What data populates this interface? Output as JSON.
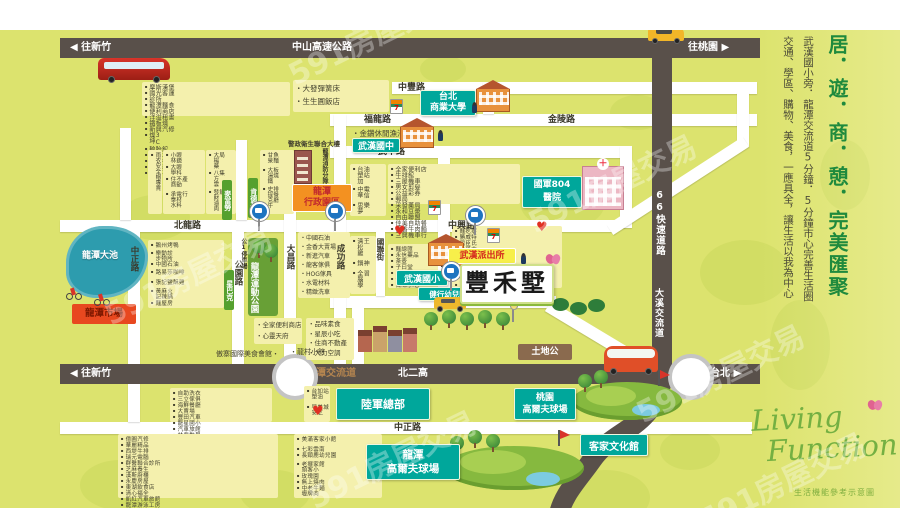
{
  "watermark_text": "591房屋交易",
  "highways": {
    "top": {
      "left": "◀ 往新竹",
      "name": "中山高速公路",
      "right": "往桃園 ▶"
    },
    "east": {
      "name": "66快速道路",
      "lower": "大溪交流道"
    },
    "bottom": {
      "left": "◀ 往新竹",
      "interchange": "龍潭交流道",
      "name": "北二高",
      "right": "往台北 ▶"
    }
  },
  "roads": {
    "zhongfeng": "中豐路",
    "fulong": "福龍路",
    "jinling": "金陵路",
    "dongfeng": "東豐路",
    "wuzhong": "武中路",
    "beilong": "北龍路",
    "zhongxing": "中興路",
    "jianxing": "健行路",
    "zhongzheng": "中正路",
    "zhongzheng_v": "中正路",
    "gongyuan": "公園路",
    "dachang": "大昌路",
    "chenggong": "成功路",
    "guolian": "國聯街",
    "wuhan": "武漢路"
  },
  "landmarks": {
    "ntub": {
      "l1": "台北",
      "l2": "商業大學"
    },
    "wuhan_jhs": "武漢國中",
    "union_bldg": "警政衛生聯合大樓",
    "fire_dept": "龍潭消防分隊",
    "admin": {
      "l1": "龍潭",
      "l2": "行政園區"
    },
    "hospital": {
      "l1": "國軍804",
      "l2": "醫院"
    },
    "wuhan_es": "武漢國小",
    "kindergarten": "健行幼兒園",
    "police": "武漢派出所",
    "project": "豐禾墅",
    "tudigong": "土地公",
    "lake": "龍潭大池",
    "market": "龍潭市場",
    "sport_park": "龍潭運動公園",
    "army": "陸軍總部",
    "golf_ty": {
      "l1": "桃園",
      "l2": "高爾夫球場"
    },
    "golf_lt": {
      "l1": "龍潭",
      "l2": "高爾夫球場"
    },
    "hakka": "客家文化館",
    "parking": "公1停車場"
  },
  "chains": {
    "mcdonalds": "麥當勞",
    "kfc": "肯德基",
    "starbucks": "星巴克"
  },
  "shops": {
    "top_left_strip": [
      "摩斯漢堡",
      "國光客運",
      "診所",
      "龍潭麵食",
      "便利商店",
      "洋溢租書",
      "鐵板燒",
      "新興汽修",
      "燦坤3C",
      "輪胎館",
      "管樂坊",
      "樂器行",
      "芸頂科技",
      "如昧花生"
    ],
    "top_bullets": [
      "大發彈簧床",
      "生生圓飯店"
    ],
    "pond_bullet": "・金鑽休閒漁池",
    "beilong_n_a": [
      "雨衣安全帽專賣"
    ],
    "beilong_n_b": [
      "小林眼鏡",
      "大學眼科",
      "住商不動產",
      "承泰水電材料行"
    ],
    "beilong_n_c": [
      "大楊藥局",
      "八方雲集",
      "發財滷肉飯"
    ],
    "beilong_n_d": [
      "甘泉魚麵",
      "大湯鐵板燒",
      "史提克牛排餐廳"
    ],
    "beilong_s": [
      "鵝州烤鴨",
      "樂步動物診所",
      "中國石油",
      "路易莎咖啡",
      "張記鹽酥雞",
      "黃記麻辣火鍋",
      "麵屋房"
    ],
    "telecom_col": [
      "台塑加油站",
      "中華電信",
      "思夢樂"
    ],
    "wuzhong_s": [
      "全家便利店",
      "牛排館",
      "三屋機車",
      "男女剪髮",
      "公益彩券",
      "郵局",
      "采發藥局",
      "永和豆漿",
      "自由聯盟",
      "佳美自助餐",
      "日香牛肉麵",
      "三興機車行"
    ],
    "zhongxing_sw": [
      "中國石油",
      "金香大賣場",
      "新進汽車",
      "龍客傢俱",
      "HOG傢具",
      "水電材料",
      "精緻洗車"
    ],
    "chenggong_e": [
      "清松雞王",
      "鍋神",
      "全腦學習"
    ],
    "school_n": [
      "麵總匯",
      "永信藥品",
      "茶壺",
      "子曰堂",
      "中友跆拳道",
      "健康補習班",
      "百味小吃"
    ],
    "zhongxing_se": [
      "麵疙瘩",
      "勝威特",
      "屈臣氏",
      "台哥大",
      "宏光藥局",
      "汽車保修廠",
      "益中藥局",
      "佑康診所",
      "美和西藥房",
      "阿木蔥油餅",
      "皇家吉利堡",
      "一番牛肉麵",
      "吉一華麵"
    ],
    "jianxing_s_a": [
      "全家便利商店",
      "心靈天府"
    ],
    "jianxing_s_b": [
      "品味素食",
      "星辰小吃",
      "住商不動產",
      "大力空調"
    ],
    "band_n_a": "傲寨國際美食會館・",
    "band_n_b": "・龍村小館",
    "band_s": [
      "自助洗衣",
      "三立傢俱",
      "海鮮餐廳",
      "大賣場",
      "豐田汽車",
      "龍星國小",
      "汽車旅館",
      "林鼎數學",
      "國泰人壽"
    ],
    "gas_col": [
      "台塑加油站",
      "早安美芝城"
    ],
    "zhongzheng_sw": [
      "億圓汽修",
      "華麗精品",
      "西堤牛排",
      "瑞元電腦",
      "群醫聯合診所",
      "芝麻養生",
      "漢斯廚櫃",
      "永慶房屋",
      "東湖飲食店",
      "清心福全",
      "凱紅汽車旅館",
      "龍潭游泳工房",
      "中油"
    ],
    "zhongzheng_s_mid": [
      "美滿客家小館",
      "七彩雲南",
      "長頸鹿幼兒園",
      "老頭擺客家小館",
      "玫瑰園",
      "無上燒肉",
      "中壢老牌牛肉麵"
    ]
  },
  "sidebar": {
    "headline": "居．遊．商．憩．完美匯聚",
    "line1": "武漢國小旁．龍潭交流道5分鐘．5分鐘市心完善生活圈",
    "line2": "交通、學區、購物、美食，一應具全，讓生活以我為中心"
  },
  "branding": {
    "l1": "Living",
    "l2": "Function",
    "caption": "生活機能參考示意圖"
  },
  "colors": {
    "teal": "#00a79b",
    "accent_green": "#1f8a3d",
    "road_dark": "#59504a",
    "bg": "#dce36e",
    "tag_green": "#55a02e"
  }
}
